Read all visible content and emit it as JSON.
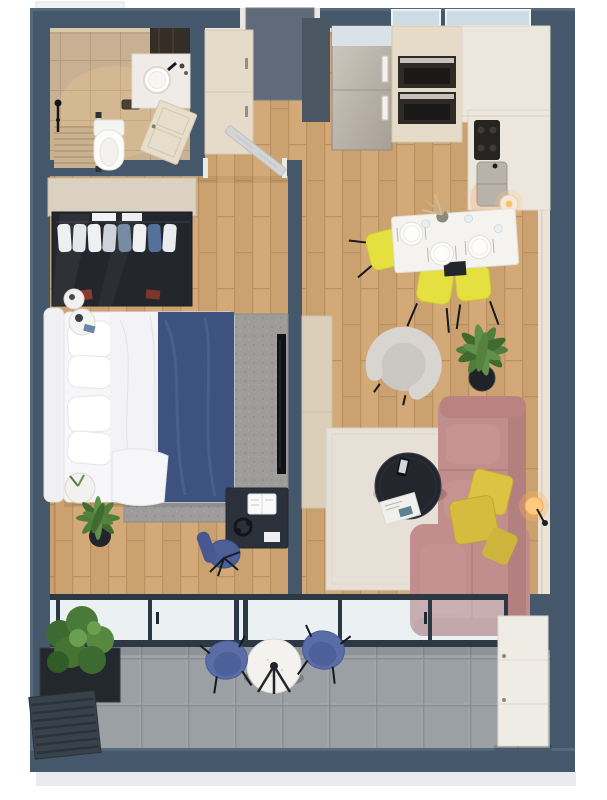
{
  "meta": {
    "type": "3d-floor-plan-render",
    "view": "top-down cutaway render of a one-bedroom apartment with balcony",
    "canvas": "607x800"
  },
  "palette": {
    "background": "#ffffff",
    "wall": "#45576a",
    "wall_light": "#55687c",
    "frame_dark": "#2c3945",
    "wood_floor": "#d2a977",
    "bath_floor": "#c8b192",
    "bath_accent": "#352e26",
    "balcony_tile": "#a0a5a9",
    "glass": "#cfdbe2",
    "cabinet_cream": "#e5dbc8",
    "counter_white": "#ece7de",
    "steel": "#b9b3ab",
    "oven_dark": "#2e2b27",
    "sofa_pink": "#c28d8d",
    "sofa_pink_dark": "#b47f7f",
    "pillow_yellow": "#dcc343",
    "chair_yellow": "#e4e040",
    "armchair_gray": "#d8d4d0",
    "rug_living": "#e6e0d6",
    "rug_bedroom": "#9d9c9a",
    "bed_white": "#f7f7f9",
    "blanket_navy": "#3e527f",
    "wardrobe_dark": "#23262d",
    "desk_dark": "#2b313a",
    "chair_blue": "#4c5f99",
    "balcony_chair_blue": "#5a6da6",
    "table_black": "#23272d",
    "plant_green": "#4f7d3c",
    "pot_black": "#1f2327",
    "lamp_warm": "#ffca7e",
    "door_entry": "#5f6b78",
    "door_leaf_gray": "#d2d4d6",
    "door_bath_cream": "#e6ddcb",
    "sideboard": "#dbcfba",
    "tv_black": "#101215",
    "exterior_band": "#e9ebee"
  },
  "rooms": [
    {
      "id": "bathroom",
      "items": [
        "walk-in-shower",
        "wall-hung-toilet",
        "vanity-sink",
        "dark-accent-wall",
        "bathroom-door"
      ]
    },
    {
      "id": "entry-hall",
      "items": [
        "entry-door",
        "hall-wardrobe",
        "dark-panel"
      ]
    },
    {
      "id": "kitchen",
      "items": [
        "fridge",
        "double-oven",
        "cooktop",
        "kitchen-sink",
        "l-counter",
        "two-windows",
        "pendant-lamp"
      ]
    },
    {
      "id": "dining-area",
      "items": [
        "dining-table",
        "three-place-settings",
        "vase-pampas",
        "yellow-chair-x3"
      ]
    },
    {
      "id": "living-room",
      "items": [
        "pink-corner-sofa",
        "yellow-pillow-x3",
        "round-coffee-table",
        "phone",
        "magazine",
        "armchair",
        "palm-plant",
        "cream-rug",
        "floor-lamp",
        "sideboard"
      ]
    },
    {
      "id": "bedroom",
      "items": [
        "double-bed",
        "navy-blanket",
        "glass-wardrobe",
        "wall-tv",
        "desk",
        "desk-chair",
        "nightstand-x3",
        "palm-plant",
        "gray-rug",
        "bedroom-door"
      ]
    },
    {
      "id": "balcony",
      "items": [
        "glazed-wall",
        "bistro-table",
        "blue-chair-x2",
        "planter-bush",
        "louver-unit",
        "storage-cabinet"
      ]
    }
  ]
}
